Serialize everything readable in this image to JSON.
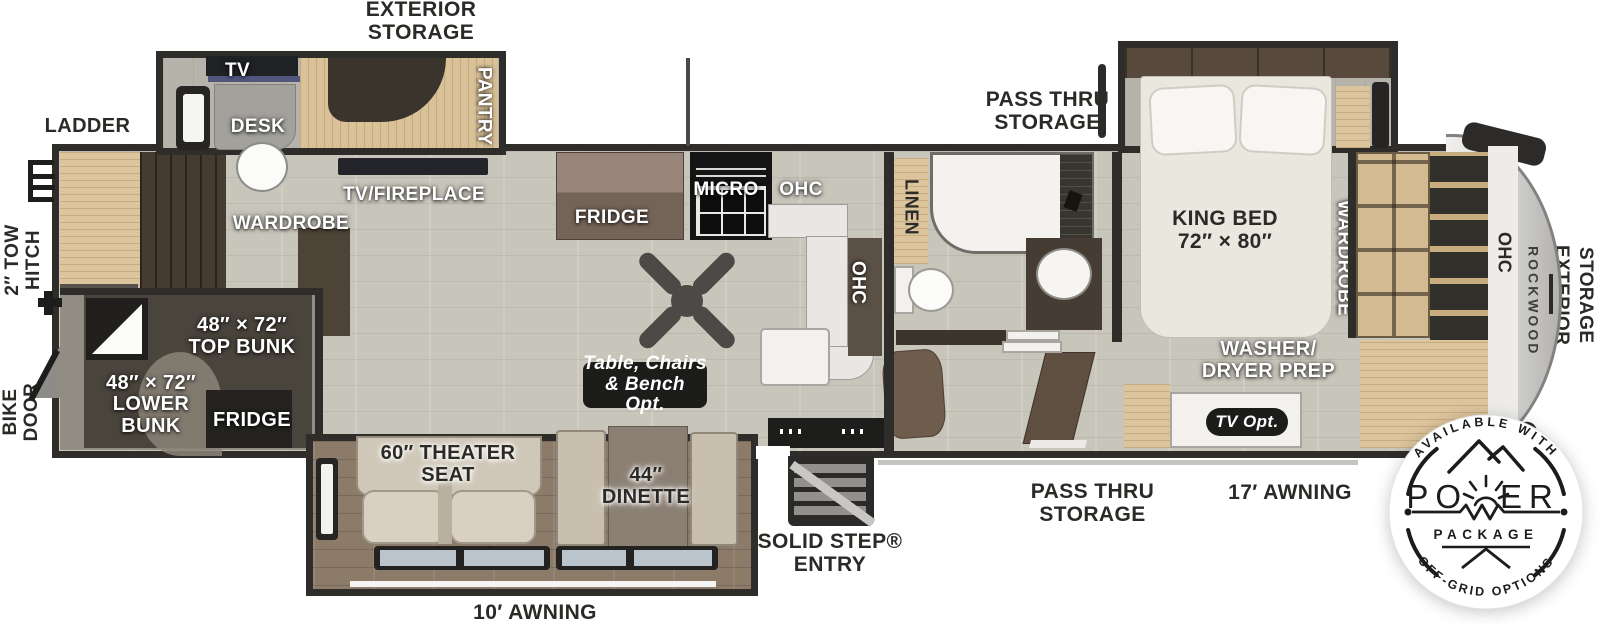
{
  "exterior": {
    "exterior_storage_top": "EXTERIOR\nSTORAGE",
    "ladder": "LADDER",
    "tow_hitch": "2″ TOW\nHITCH",
    "bike_door": "BIKE\nDOOR",
    "pass_thru_storage_top": "PASS THRU\nSTORAGE",
    "pass_thru_storage_bottom": "PASS THRU\nSTORAGE",
    "solid_step_entry": "SOLID STEP®\nENTRY",
    "awning_10": "10′ AWNING",
    "awning_17": "17′ AWNING",
    "exterior_storage_right": "EXTERIOR\nSTORAGE",
    "brand": "ROCKWOOD"
  },
  "interior": {
    "tv": "TV",
    "desk": "DESK",
    "pantry": "PANTRY",
    "tv_fireplace": "TV/FIREPLACE",
    "wardrobe_front": "WARDROBE",
    "top_bunk": "48″ × 72″\nTOP BUNK",
    "lower_bunk": "48″ × 72″\nLOWER\nBUNK",
    "bunk_fridge": "FRIDGE",
    "kitchen_fridge": "FRIDGE",
    "micro": "MICRO",
    "ohc_kitchen": "OHC",
    "ohc_island": "OHC",
    "table_opt": "Table, Chairs\n& Bench Opt.",
    "theater_seat": "60″ THEATER\nSEAT",
    "dinette": "44″\nDINETTE",
    "linen": "LINEN",
    "king_bed": "KING BED\n72″ × 80″",
    "wardrobe_bedroom": "WARDROBE",
    "washer_dryer": "WASHER/\nDRYER PREP",
    "tv_opt": "TV Opt.",
    "ohc_rear": "OHC"
  },
  "badge": {
    "available": "AVAILABLE WITH",
    "power_left": "PO",
    "power_right": "ER",
    "package": "PACKAGE",
    "offgrid": "OFF-GRID OPTIONS"
  }
}
